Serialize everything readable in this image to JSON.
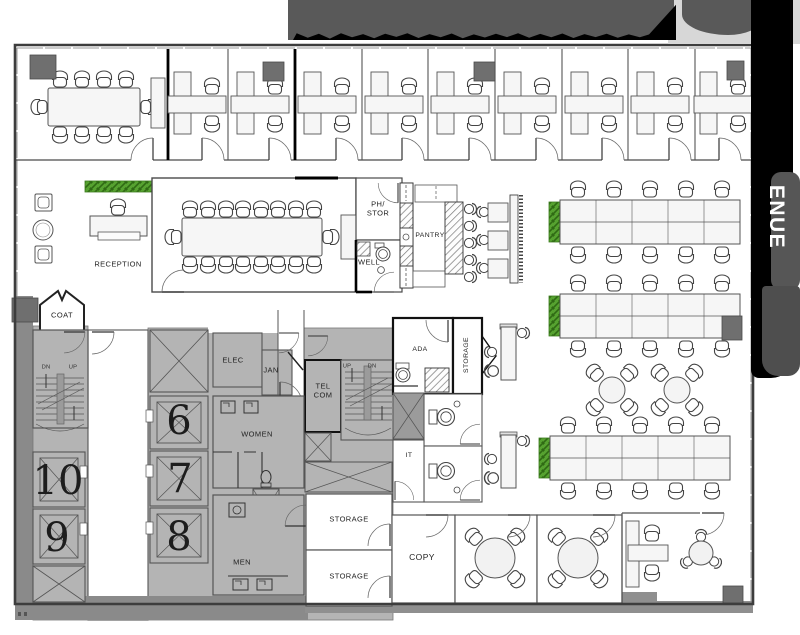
{
  "street_band": {
    "label": "ENUE"
  },
  "rooms": {
    "reception": "RECEPTION",
    "coat": "COAT",
    "elec": "ELEC",
    "jan": "JAN",
    "telcom": "TEL\nCOM",
    "women": "WOMEN",
    "men": "MEN",
    "phstor": "PH/\nSTOR",
    "well": "WELL",
    "pantry": "PANTRY",
    "ada": "ADA",
    "storage_core": "STORAGE",
    "it": "IT",
    "storage_1": "STORAGE",
    "storage_2": "STORAGE",
    "copy": "COPY"
  },
  "stairs": {
    "stair1_dn": "DN",
    "stair1_up": "UP",
    "stair2_up": "UP",
    "stair2_dn": "DN"
  },
  "elevators": {
    "e6": "6",
    "e7": "7",
    "e8": "8",
    "e9": "9",
    "e10": "10"
  },
  "colors": {
    "core_fill": "#b4b4b4",
    "core_dark": "#8a8a8a",
    "column": "#6f6f6f",
    "wall": "#3d3d3d",
    "plant_green": "#56a230",
    "banner_gray": "#595959",
    "band_black": "#000000"
  }
}
